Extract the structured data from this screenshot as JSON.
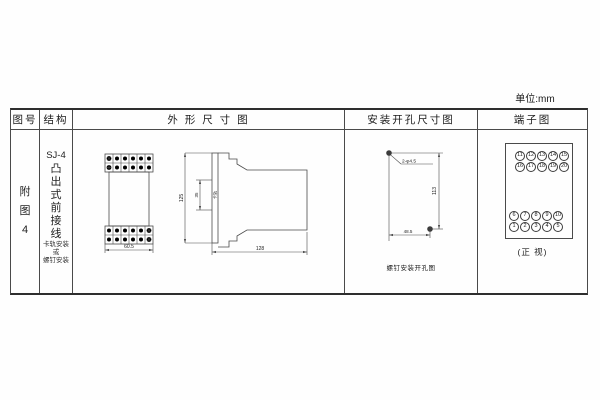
{
  "unit_label": "单位:mm",
  "headers": {
    "figure_no": "图号",
    "structure": "结构",
    "outline": "外 形 尺 寸 图",
    "mounting_hole": "安装开孔尺寸图",
    "terminal": "端子图"
  },
  "figure_no": {
    "chars": [
      "附",
      "图",
      "4"
    ]
  },
  "structure": {
    "model": "SJ-4",
    "type_chars": [
      "凸",
      "出",
      "式",
      "前",
      "接",
      "线"
    ],
    "mounting_lines": [
      "卡轨安装",
      "或",
      "螺钉安装"
    ]
  },
  "outline": {
    "front_width": "60.5",
    "height": "125",
    "rail_notch": "35",
    "rail_label": "卡轨",
    "depth": "128"
  },
  "mounting": {
    "hole_label": "2-φ4.5",
    "vertical_dim": "113",
    "horizontal_dim": "48.5",
    "caption": "螺钉安装开孔图"
  },
  "terminal": {
    "caption": "(正 视)",
    "top_rows": [
      [
        "11",
        "12",
        "13",
        "14",
        "15"
      ],
      [
        "16",
        "17",
        "18",
        "19",
        "20"
      ]
    ],
    "bottom_rows": [
      [
        "6",
        "7",
        "8",
        "9",
        "10"
      ],
      [
        "1",
        "2",
        "3",
        "4",
        "5"
      ]
    ]
  }
}
